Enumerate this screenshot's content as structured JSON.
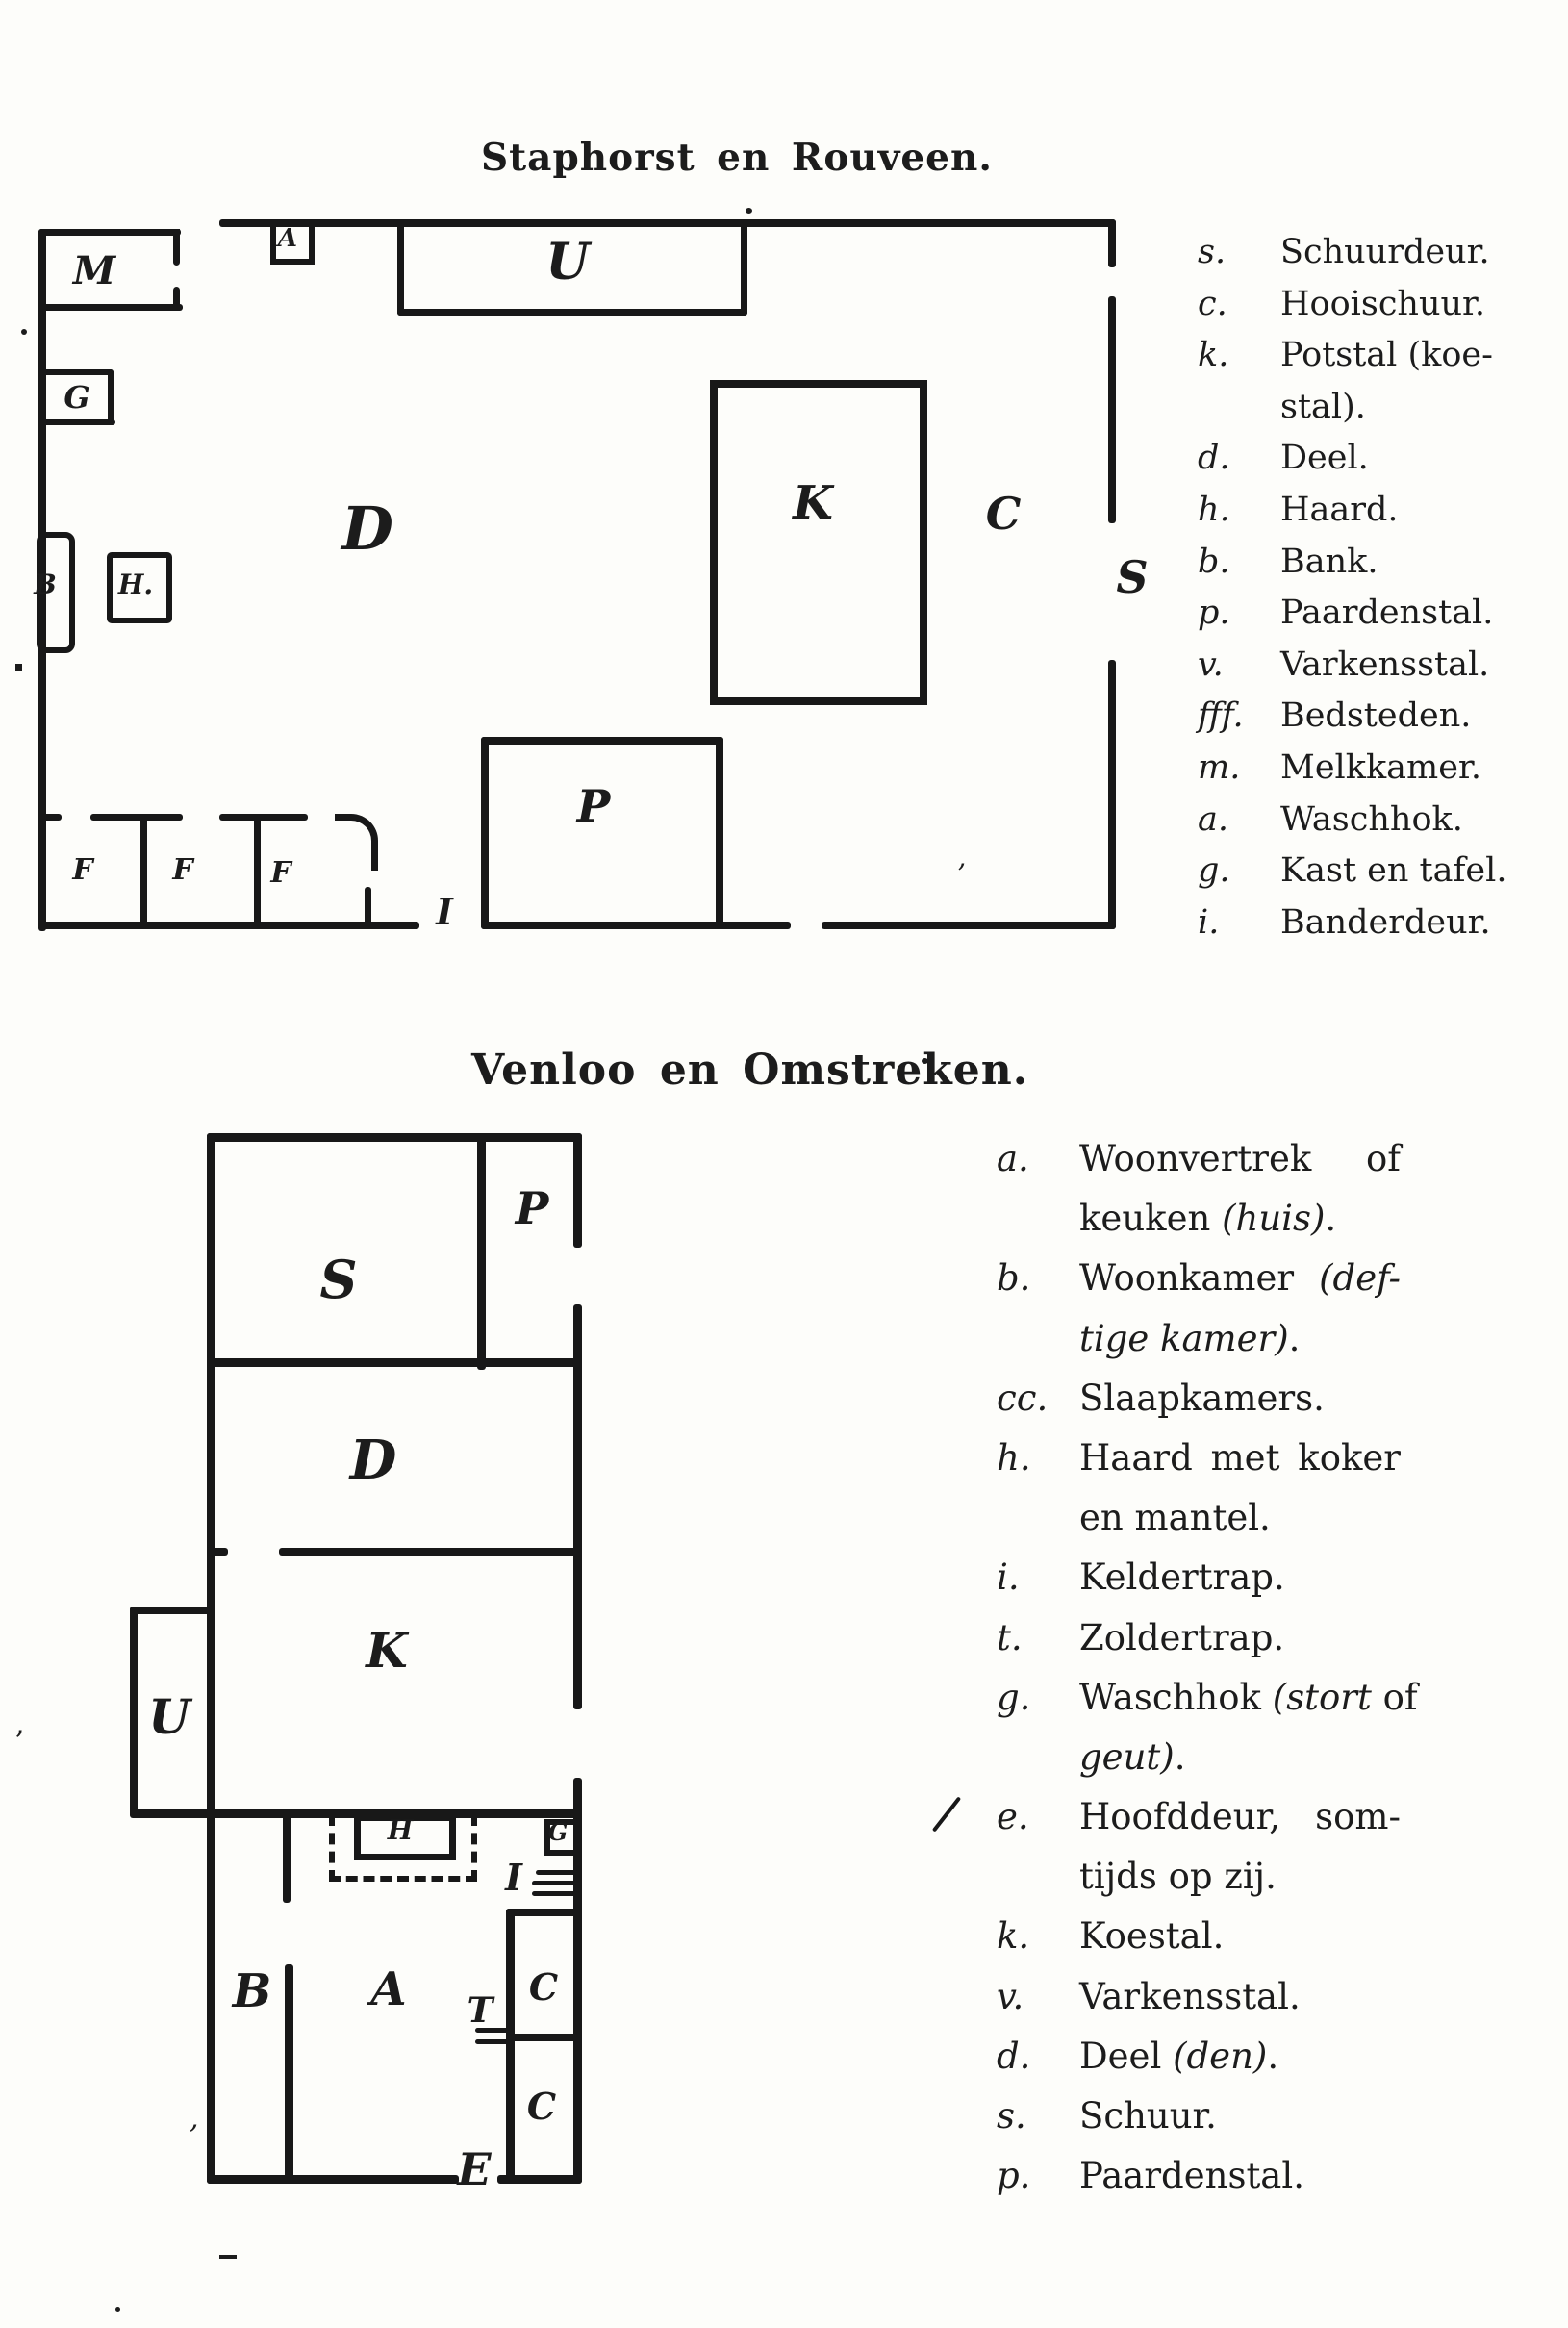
{
  "page": {
    "background": "#fdfdfa",
    "ink": "#181818"
  },
  "plan1": {
    "title": "Staphorst en Rouveen.",
    "rooms": {
      "m": "M",
      "a": "A",
      "u": "U",
      "g": "G",
      "b": "B",
      "h": "H.",
      "d": "D",
      "k": "K",
      "c": "C",
      "s": "S",
      "p": "P",
      "f1": "F",
      "f2": "F",
      "f3": "F",
      "i": "I"
    },
    "legend": [
      {
        "k": "s.",
        "t1": "Schuurdeur."
      },
      {
        "k": "c.",
        "t1": "Hooischuur."
      },
      {
        "k": "k.",
        "t1": "Potstal (koe-"
      },
      {
        "k": "",
        "t1": "stal)."
      },
      {
        "k": "d.",
        "t1": "Deel."
      },
      {
        "k": "h.",
        "t1": "Haard."
      },
      {
        "k": "b.",
        "t1": "Bank."
      },
      {
        "k": "p.",
        "t1": "Paardenstal."
      },
      {
        "k": "v.",
        "t1": "Varkensstal."
      },
      {
        "k": "fff.",
        "t1": "Bedsteden."
      },
      {
        "k": "m.",
        "t1": "Melkkamer."
      },
      {
        "k": "a.",
        "t1": "Waschhok."
      },
      {
        "k": "g.",
        "t1": "Kast en tafel."
      },
      {
        "k": "i.",
        "t1": "Banderdeur."
      }
    ]
  },
  "plan2": {
    "title": "Venloo en Omstreken.",
    "rooms": {
      "s": "S",
      "p": "P",
      "d": "D",
      "k": "K",
      "u": "U",
      "h": "H",
      "g": "G",
      "i": "I",
      "b": "B",
      "a": "A",
      "t": "T",
      "c1": "C",
      "c2": "C",
      "e": "E"
    },
    "legend": [
      {
        "k": "a.",
        "t1": "Woonvertrek of"
      },
      {
        "k": "",
        "t1": "keuken ",
        "t2": "(huis)",
        "t3": "."
      },
      {
        "k": "b.",
        "t1": "Woonkamer ",
        "t2": "(def-"
      },
      {
        "k": "",
        "t2": "tige kamer)",
        "t3": "."
      },
      {
        "k": "cc.",
        "t1": "Slaapkamers."
      },
      {
        "k": "h.",
        "t1": "Haard met koker"
      },
      {
        "k": "",
        "t1": "en mantel."
      },
      {
        "k": "i.",
        "t1": "Keldertrap."
      },
      {
        "k": "t.",
        "t1": "Zoldertrap."
      },
      {
        "k": "g.",
        "t1": "Waschhok ",
        "t2": "(stort",
        "t3": " of"
      },
      {
        "k": "",
        "t2": "geut)",
        "t3": "."
      },
      {
        "k": "e.",
        "t1": "Hoofddeur, som-"
      },
      {
        "k": "",
        "t1": "tijds op zij."
      },
      {
        "k": "k.",
        "t1": "Koestal."
      },
      {
        "k": "v.",
        "t1": "Varkensstal."
      },
      {
        "k": "d.",
        "t1": "Deel ",
        "t2": "(den)",
        "t3": "."
      },
      {
        "k": "s.",
        "t1": "Schuur."
      },
      {
        "k": "p.",
        "t1": "Paardenstal."
      }
    ]
  }
}
